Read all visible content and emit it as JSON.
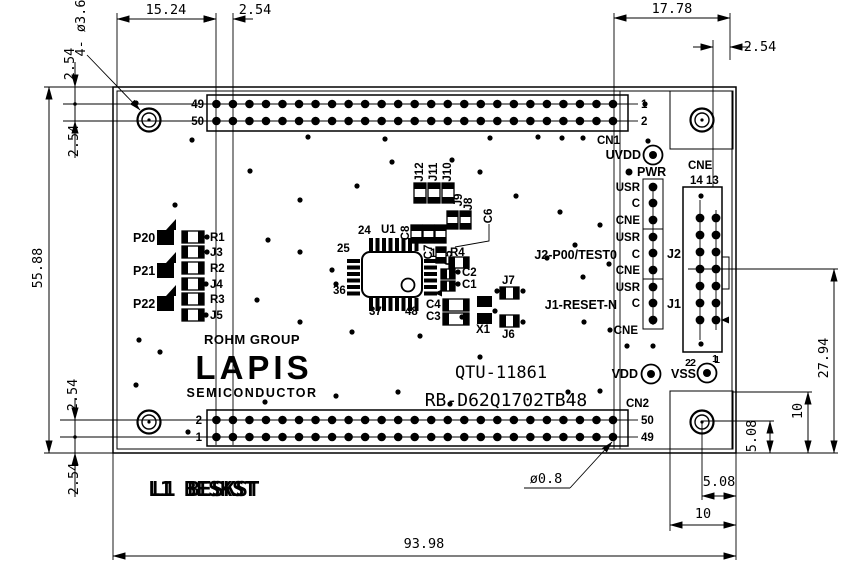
{
  "dims": {
    "d1524": "15.24",
    "d254": "2.54",
    "hole_note": "4- ø3.6",
    "d5588": "55.88",
    "d1778": "17.78",
    "d2794": "27.94",
    "d10": "10",
    "d508": "5.08",
    "d9398": "93.98",
    "pin_dia": "ø0.8"
  },
  "board": {
    "cn1": "CN1",
    "cn2": "CN2",
    "cne": "CNE",
    "cne_cols": "14 13",
    "cne_pin2": "2",
    "cne_pin1": "1",
    "uvdd": "UVDD",
    "pwr": "PWR",
    "vdd": "VDD",
    "vss": "VSS",
    "vss2": "2",
    "vss1": "1",
    "j2": "J2",
    "j1": "J1",
    "usr": "USR",
    "c": "C",
    "cne_row": "CNE",
    "j2_signal": "J2-P00/TEST0",
    "j1_signal": "J1-RESET-N",
    "cn1_left_top": "49",
    "cn1_left_bottom": "50",
    "cn1_right_top": "1",
    "cn1_right_bottom": "2",
    "cn2_left_top": "2",
    "cn2_left_bottom": "1",
    "cn2_right_top": "50",
    "cn2_right_bottom": "49",
    "logo_group": "ROHM GROUP",
    "logo_brand": "LAPIS",
    "logo_sub": "SEMICONDUCTOR",
    "title1": "QTU-11861",
    "title2": "RB-D62Q1702TB48",
    "silk_misc": "L1 BESKST",
    "u1": "U1",
    "pin24": "24",
    "pin25": "25",
    "pin36": "36",
    "pin37": "37",
    "pin48": "48",
    "pin12": "12",
    "r4": "R4",
    "c1": "C1",
    "c2": "C2",
    "c3": "C3",
    "c4": "C4",
    "c5": "C5",
    "c6": "C6",
    "c7": "C7",
    "c8": "C8",
    "x1": "X1",
    "j6": "J6",
    "j7": "J7",
    "j8": "J8",
    "j9": "J9",
    "j10": "J10",
    "j11": "J11",
    "j12": "J12",
    "p20": "P20",
    "p21": "P21",
    "p22": "P22",
    "r1": "R1",
    "r2": "R2",
    "r3": "R3",
    "j3": "J3",
    "j4": "J4",
    "j5": "J5"
  }
}
